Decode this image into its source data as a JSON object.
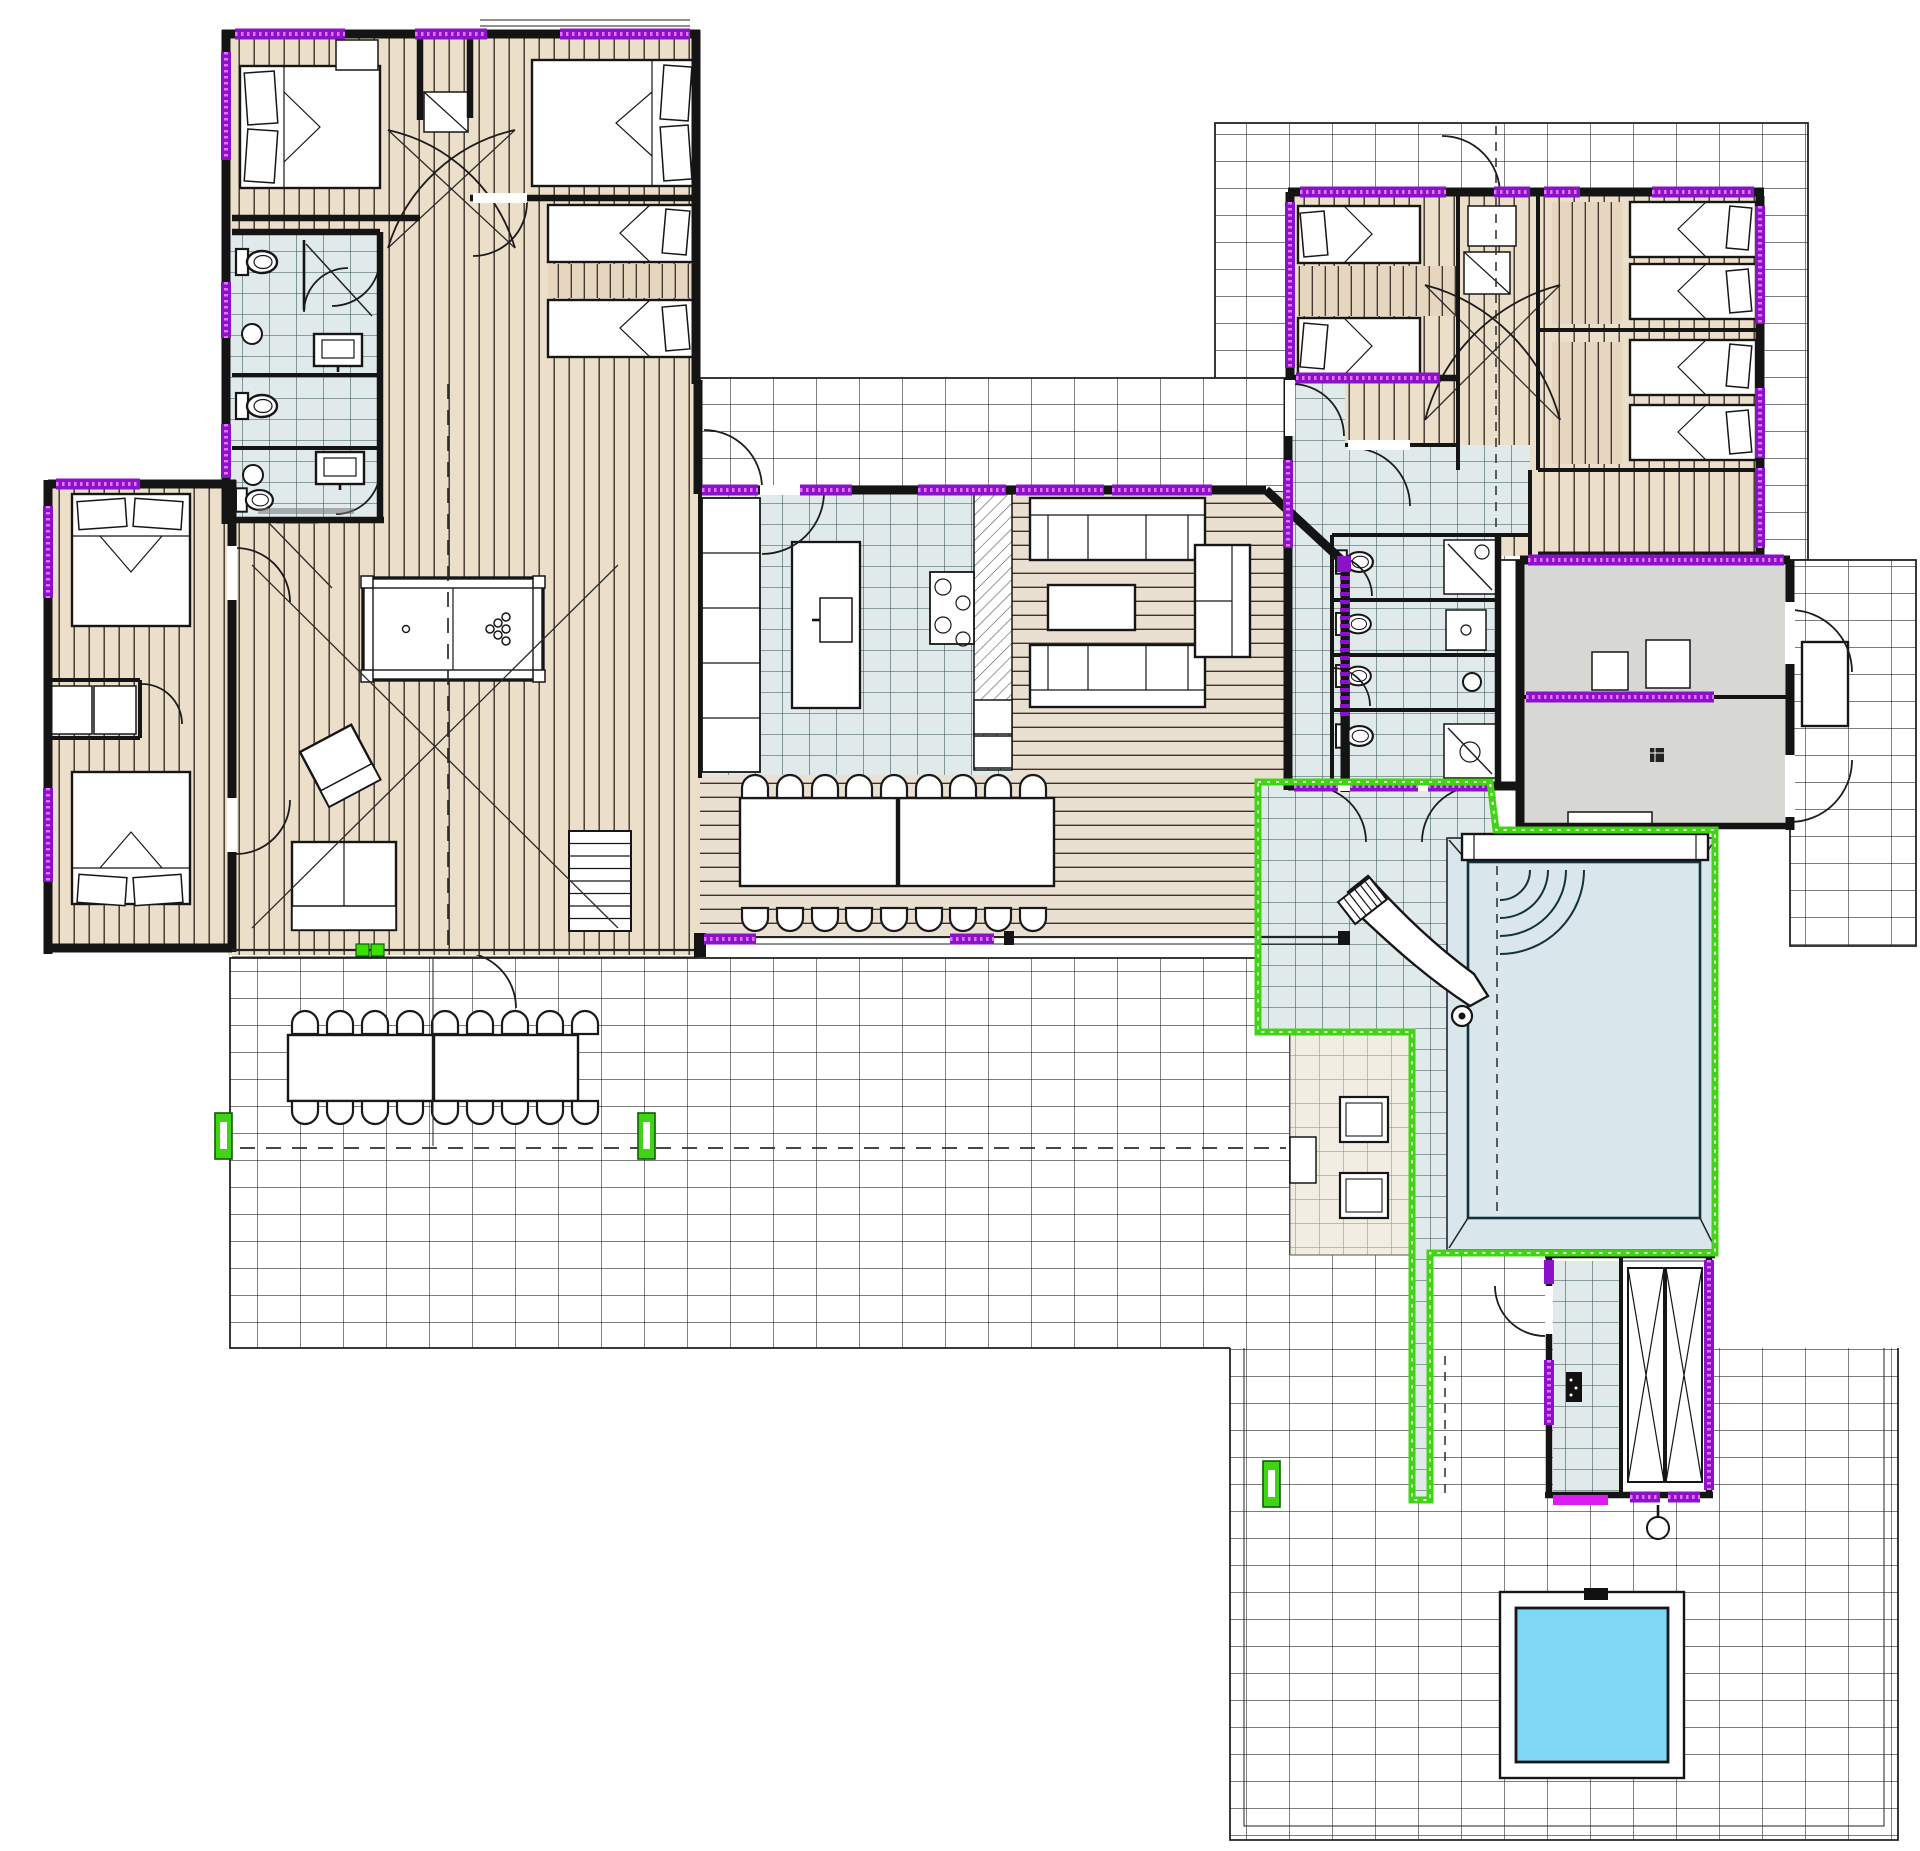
{
  "document": {
    "kind": "architectural-floor-plan",
    "visible_text": [],
    "note": "plan drawing only - no legible labels"
  },
  "colors": {
    "wall": "#141414",
    "wood_light": "#ecdfca",
    "wood_dining": "#eae0d2",
    "tile_indoor": "#e1eaeb",
    "gray_room": "#d7d7d4",
    "pool_water": "#7ed7f4",
    "fence_green": "#41d414",
    "door_green": "#39e000",
    "window_purple": "#8a12c9",
    "window_purple_light": "#e571ff",
    "door_magenta": "#db1cf2",
    "paver": "#f2ede3",
    "terrace_line": "#2f2f2f"
  },
  "plan": {
    "areas": [
      "northwest-bedroom-wing",
      "west-bedrooms",
      "great-room",
      "kitchen",
      "living-room",
      "indoor-dining",
      "east-bedroom-wing",
      "bathrooms",
      "garage-storage",
      "pool-deck",
      "swimming-pool",
      "pool-house",
      "plunge-pool",
      "outdoor-terraces"
    ],
    "counts": {
      "double_beds": 4,
      "single_beds": 8,
      "toilets": 7,
      "sofas": 3,
      "armchairs": 2,
      "indoor_dining_chairs": 18,
      "outdoor_dining_chairs": 18,
      "pools": 2,
      "billiard_tables": 1,
      "water_slides": 1
    }
  }
}
